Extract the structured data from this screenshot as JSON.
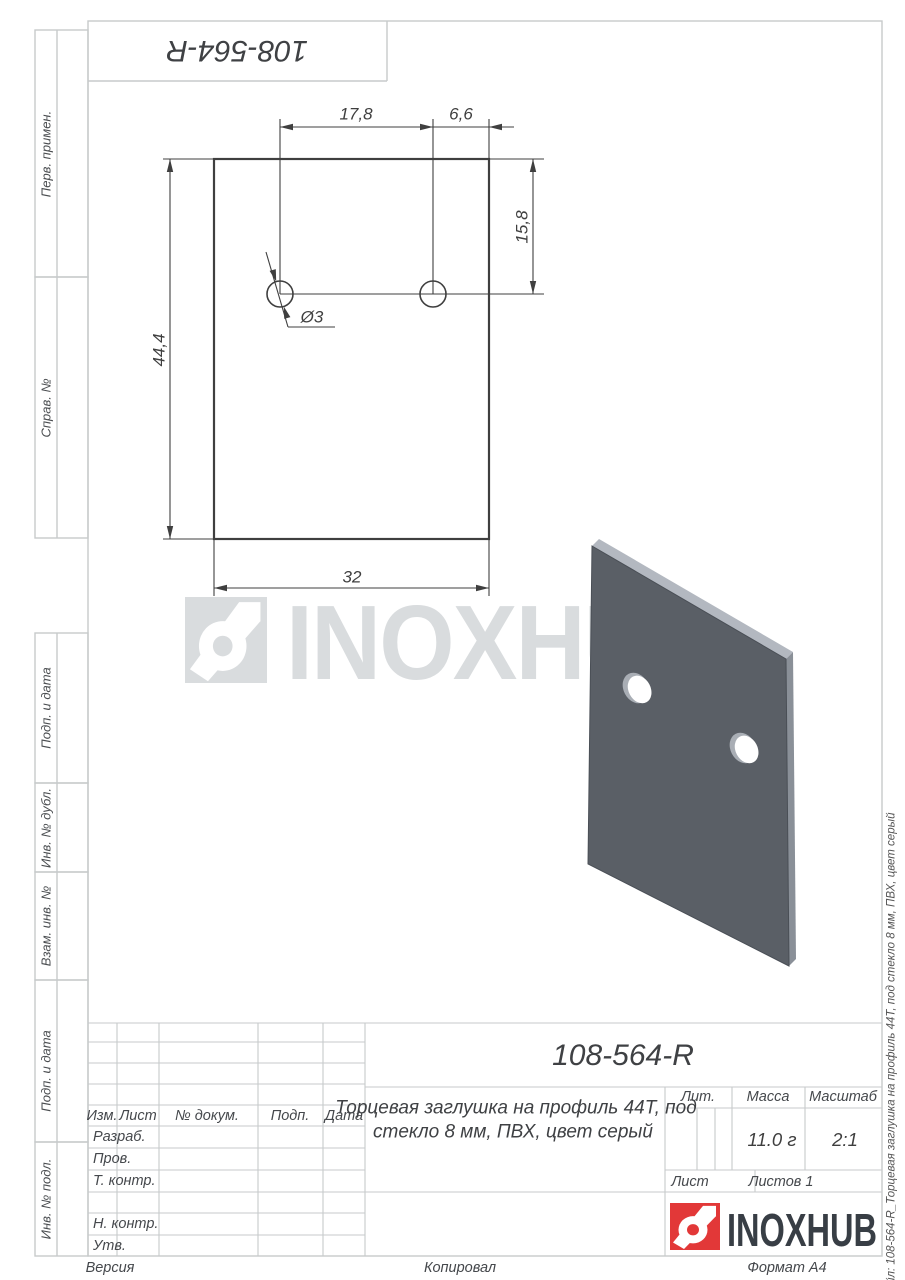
{
  "page": {
    "top_box_code": "108-564-R",
    "bottom_bar": {
      "left": "Версия",
      "center": "Копировал",
      "right": "Формат А4"
    },
    "right_margin_file_label": "Файл: 108-564-R_Торцевая заглушка на профиль 44Т, под стекло 8 мм, ПВХ, цвет серый"
  },
  "side_labels": {
    "perv_primen": "Перв. примен.",
    "sprav_no": "Справ. №",
    "podp_data_1": "Подп. и дата",
    "inv_dubl": "Инв. № дубл.",
    "vzam_inv": "Взам. инв. №",
    "podp_data_2": "Подп. и дата",
    "inv_podl": "Инв. № подл."
  },
  "drawing": {
    "dimensions": {
      "hole_spacing": "17,8",
      "edge_offset": "6,6",
      "top_offset": "15,8",
      "height": "44,4",
      "width": "32",
      "hole_diameter": "Ø3"
    }
  },
  "watermark": {
    "text": "INOXHUB"
  },
  "title_block": {
    "code": "108-564-R",
    "name_line1": "Торцевая заглушка на профиль 44Т, под",
    "name_line2": "стекло 8 мм, ПВХ, цвет серый",
    "headers": {
      "izm": "Изм.",
      "list": "Лист",
      "dokum": "№ докум.",
      "podp": "Подп.",
      "data": "Дата"
    },
    "rows": {
      "razrab": "Разраб.",
      "prov": "Пров.",
      "t_kontr": "Т. контр.",
      "n_kontr": "Н. контр.",
      "utv": "Утв."
    },
    "lit_label": "Лит.",
    "massa_label": "Масса",
    "masshtab_label": "Масштаб",
    "massa_value": "11.0 г",
    "masshtab_value": "2:1",
    "list_label": "Лист",
    "listov_label": "Листов 1",
    "logo_text": "INOXHUB"
  },
  "colors": {
    "accent_red": "#e23838",
    "plate_gray": "#5a5f66",
    "watermark_gray": "#d9dcde",
    "frame_gray": "#c7cacb",
    "line_dark": "#3f3f3f"
  }
}
